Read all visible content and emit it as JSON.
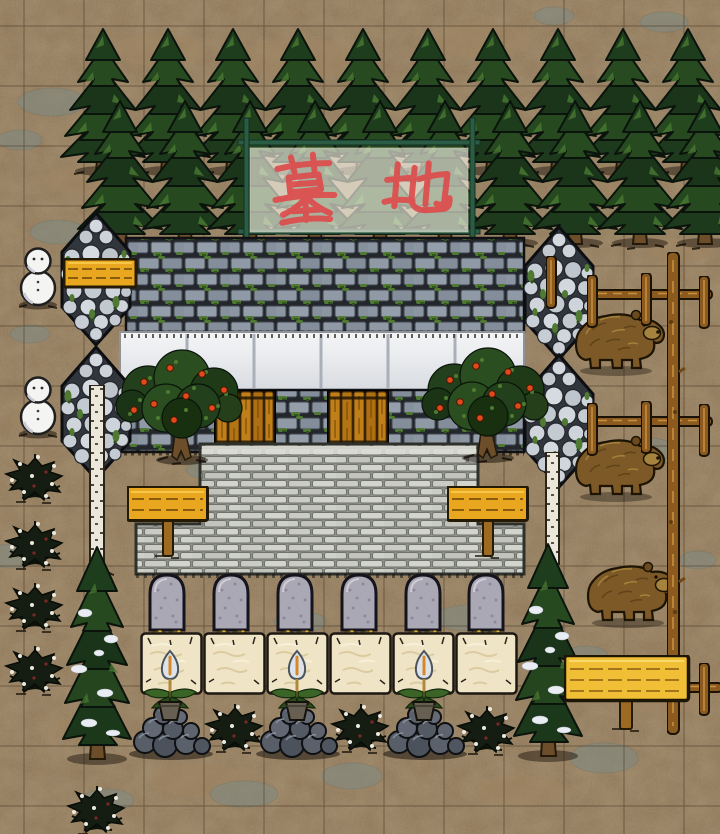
{
  "banner": {
    "text": "墓地",
    "color": "#de4a4a"
  },
  "palette": {
    "dirt": "#8d7557",
    "grid": "#4a3a24",
    "stonepatch": "#7e8b85",
    "tanpatch": "#a08662",
    "sign": "#e8a71e",
    "signbig": "#f0bf35",
    "door": "#c07f18",
    "cream": "#efe5c6",
    "flame": "#dde3e8",
    "flamecore": "#d8882a",
    "fence": "#8a5a1e",
    "snow": "#f4f4f2",
    "bear": "#7c5926",
    "bearsnout": "#a5823e",
    "frame": "#2b5c46",
    "cloth": "#f3f1e3",
    "bannertext": "#de4a4a",
    "apple": "#e04a1a",
    "moss": "#4e7a31",
    "grave": "#aba8b5",
    "rock": "#5a616b",
    "bush": "#151c11",
    "berry": "#ece9df",
    "wallbrick": "#9099a6",
    "whitewall": "#e9ebee",
    "floorbrick": "#cacbc3",
    "cobble": "#ccd2d9"
  },
  "grid": {
    "size": 60,
    "ox": 24,
    "oy": 26,
    "color": "rgba(50,38,22,0.45)"
  },
  "ground": {
    "stone_patches": [
      [
        52,
        102,
        34,
        14
      ],
      [
        20,
        140,
        22,
        10
      ],
      [
        58,
        232,
        28,
        12
      ],
      [
        12,
        556,
        26,
        12
      ],
      [
        218,
        530,
        30,
        12
      ],
      [
        438,
        532,
        26,
        10
      ],
      [
        300,
        622,
        26,
        11
      ],
      [
        468,
        618,
        34,
        13
      ],
      [
        614,
        336,
        26,
        12
      ],
      [
        648,
        452,
        32,
        14
      ],
      [
        604,
        758,
        34,
        15
      ],
      [
        352,
        776,
        30,
        13
      ],
      [
        244,
        794,
        34,
        13
      ],
      [
        108,
        800,
        26,
        11
      ],
      [
        664,
        22,
        24,
        10
      ],
      [
        554,
        16,
        20,
        9
      ],
      [
        698,
        560,
        18,
        9
      ],
      [
        586,
        656,
        22,
        10
      ],
      [
        684,
        104,
        20,
        9
      ],
      [
        30,
        334,
        20,
        9
      ],
      [
        208,
        470,
        22,
        9
      ],
      [
        628,
        598,
        24,
        10
      ]
    ],
    "tan_patches": [
      [
        300,
        58,
        60,
        20
      ],
      [
        480,
        40,
        50,
        18
      ],
      [
        160,
        50,
        46,
        16
      ],
      [
        620,
        180,
        40,
        16
      ],
      [
        80,
        180,
        36,
        14
      ],
      [
        200,
        780,
        50,
        16
      ],
      [
        520,
        790,
        44,
        15
      ],
      [
        660,
        700,
        40,
        14
      ],
      [
        90,
        730,
        40,
        14
      ],
      [
        40,
        420,
        30,
        12
      ],
      [
        680,
        250,
        30,
        12
      ]
    ]
  },
  "objects": {
    "pines_back": {
      "y": 26,
      "x": [
        48,
        113,
        178,
        243,
        308,
        373,
        438,
        503,
        568,
        633
      ]
    },
    "pines_front": {
      "y": 98,
      "x": [
        65,
        130,
        195,
        260,
        325,
        390,
        455,
        520,
        585,
        650
      ]
    },
    "towers": [
      {
        "x": 58,
        "y": 210
      },
      {
        "x": 58,
        "y": 344
      },
      {
        "x": 521,
        "y": 224
      },
      {
        "x": 521,
        "y": 352
      }
    ],
    "birches": [
      {
        "t": "birch",
        "x": 89,
        "y": 385
      },
      {
        "t": "birch-s",
        "x": 545,
        "y": 452
      }
    ],
    "wall_signs": [
      {
        "x": 63,
        "y": 258
      }
    ],
    "apple_trees": [
      {
        "x": 110,
        "y": 348
      },
      {
        "x": 416,
        "y": 346
      }
    ],
    "standing_signs": [
      {
        "x": 127,
        "y": 486
      },
      {
        "x": 447,
        "y": 486
      }
    ],
    "graves": {
      "y": 570,
      "x": [
        143,
        207,
        271,
        335,
        399,
        462
      ]
    },
    "cream_blocks": {
      "y": 632,
      "x": [
        140,
        203,
        266,
        329,
        392,
        455
      ]
    },
    "pines_tall": [
      {
        "x": 55,
        "y": 543
      },
      {
        "x": 506,
        "y": 540
      }
    ],
    "snowmen": [
      {
        "x": 15,
        "y": 246
      },
      {
        "x": 15,
        "y": 375
      }
    ],
    "bushes": [
      {
        "x": 4,
        "y": 446
      },
      {
        "x": 4,
        "y": 513
      },
      {
        "x": 4,
        "y": 575
      },
      {
        "x": 4,
        "y": 638
      },
      {
        "x": 66,
        "y": 778
      },
      {
        "x": 204,
        "y": 696
      },
      {
        "x": 330,
        "y": 696
      },
      {
        "x": 456,
        "y": 698
      }
    ],
    "rock_piles": {
      "y": 698,
      "x": [
        125,
        252,
        379
      ]
    },
    "torch_plants": {
      "y": 648,
      "x": [
        140,
        267,
        394
      ]
    },
    "bears": [
      {
        "x": 566,
        "y": 298
      },
      {
        "x": 566,
        "y": 424
      },
      {
        "x": 578,
        "y": 550
      }
    ],
    "fence_rails": [
      {
        "x": 590,
        "y": 288
      },
      {
        "x": 590,
        "y": 415
      }
    ],
    "fence_rails_s": [
      {
        "x": 680,
        "y": 681
      }
    ],
    "fence_posts_l": [
      {
        "x": 667,
        "y": 252
      }
    ],
    "fence_posts": [
      {
        "x": 587,
        "y": 275
      },
      {
        "x": 641,
        "y": 273
      },
      {
        "x": 699,
        "y": 276
      },
      {
        "x": 587,
        "y": 403
      },
      {
        "x": 641,
        "y": 401
      },
      {
        "x": 699,
        "y": 404
      },
      {
        "x": 546,
        "y": 256
      },
      {
        "x": 699,
        "y": 663
      }
    ],
    "doors": [
      {
        "x": 214,
        "y": 390
      },
      {
        "x": 327,
        "y": 390
      }
    ],
    "big_signs": [
      {
        "x": 564,
        "y": 655
      }
    ]
  }
}
